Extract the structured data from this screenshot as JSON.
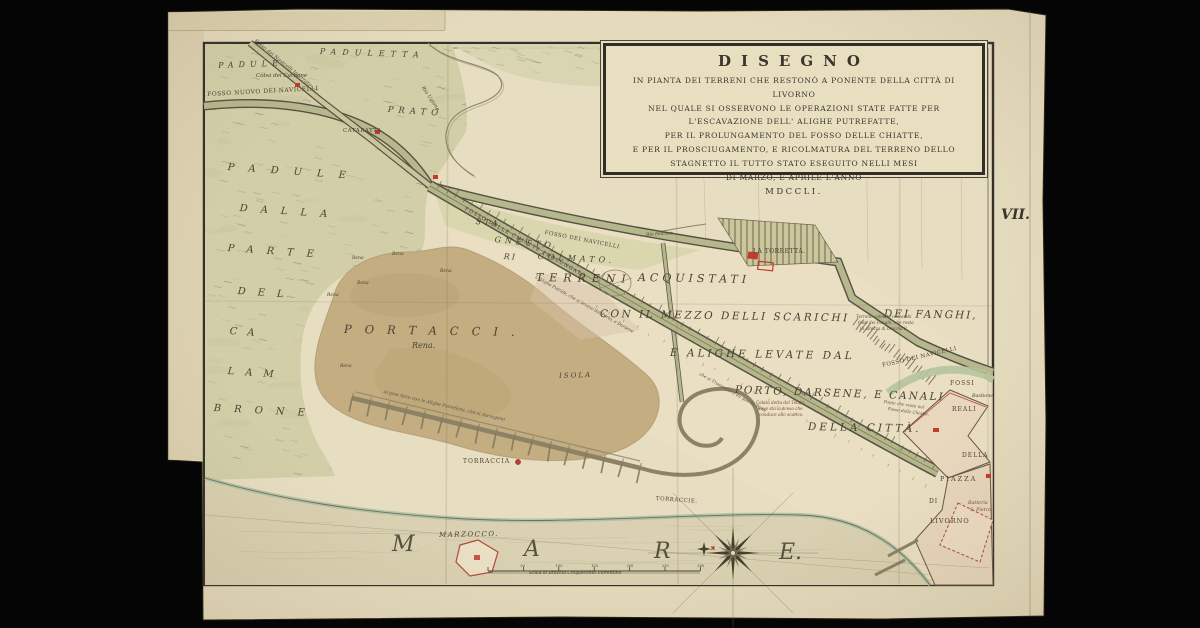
{
  "cartouche": {
    "title": "DISEGNO",
    "lines": [
      "IN PIANTA DEI TERRENI CHE RESTONÒ A PONENTE DELLA CITTÀ DI LIVORNO",
      "NEL QUALE SI OSSERVONO LE OPERAZIONI STATE FATTE PER",
      "L'ESCAVAZIONE DELL' ALIGHE PUTREFATTE,",
      "PER IL PROLUNGAMENTO DEL FOSSO DELLE CHIATTE,",
      "E PER IL PROSCIUGAMENTO, E RICOLMATURA DEL TERRENO DELLO",
      "STAGNETTO IL TUTTO STATO ESEGUITO NELLI MESI",
      "DI MARZO, E APRILE L'ANNO",
      "MDCCLI."
    ]
  },
  "plate_mark": "VII.",
  "scale_bar": {
    "label": "Scala di Braccia Cinquecento Fiorentine",
    "ticks": [
      "50",
      "100",
      "150",
      "200",
      "250",
      "300"
    ]
  },
  "colors": {
    "paper": "#e4dabc",
    "marsh": "#d2cfa8",
    "sand": "#c3ad81",
    "canal": "#b5b68a",
    "accent_red": "#c23b2a",
    "ink": "#4a4334",
    "background": "#050505"
  },
  "map_labels": [
    {
      "n": "padule-top",
      "t": "PADULE",
      "x": 218,
      "y": 62,
      "s": 8,
      "ls": 5,
      "r": -2,
      "i": 1
    },
    {
      "n": "paduletta",
      "t": "PADULETTA",
      "x": 320,
      "y": 48,
      "s": 8,
      "ls": 6,
      "r": 2,
      "i": 1
    },
    {
      "n": "colsa-del-carbone",
      "t": "Cólsa del Carbone",
      "x": 256,
      "y": 74,
      "s": 5.5,
      "i": 1
    },
    {
      "n": "fosso-nuovo-dei-navicelli",
      "t": "FOSSO NUOVO DEI NAVICELLI",
      "x": 207,
      "y": 92,
      "s": 6,
      "ls": 0.5,
      "r": -3
    },
    {
      "n": "fosso-navicelli-interrato",
      "t": "Fosso dei Navicelli Interrato",
      "x": 256,
      "y": 39,
      "s": 5,
      "r": 39,
      "i": 1
    },
    {
      "n": "rio-ugione",
      "t": "Rio Ugione",
      "x": 424,
      "y": 86,
      "s": 5,
      "r": 56,
      "i": 1
    },
    {
      "n": "prato",
      "t": "PRATO",
      "x": 388,
      "y": 106,
      "s": 8.5,
      "ls": 5,
      "r": 4,
      "i": 1
    },
    {
      "n": "cataratta",
      "t": "CATARATTA",
      "x": 343,
      "y": 129,
      "s": 5.5,
      "ls": 0.5
    },
    {
      "n": "stagnetto-sta",
      "t": "STA",
      "x": 476,
      "y": 218,
      "s": 8,
      "ls": 3,
      "r": 6,
      "i": 1
    },
    {
      "n": "stagnetto-gnetto",
      "t": "GNETTO",
      "x": 495,
      "y": 236,
      "s": 8,
      "ls": 4,
      "r": 6,
      "i": 1
    },
    {
      "n": "stagnetto-ri",
      "t": "RI",
      "x": 504,
      "y": 253,
      "s": 8,
      "ls": 2,
      "r": 4,
      "i": 1
    },
    {
      "n": "stagnetto-colmato",
      "t": "COLMATO.",
      "x": 538,
      "y": 253,
      "s": 8,
      "ls": 4,
      "r": 3,
      "i": 1
    },
    {
      "n": "fosso-dei-navicelli-mid",
      "t": "FOSSO DEI NAVICELLI",
      "x": 545,
      "y": 231,
      "s": 5.5,
      "ls": 0.5,
      "r": 11
    },
    {
      "n": "rio-felciaio",
      "t": "Rio Felciaio",
      "x": 646,
      "y": 234,
      "s": 4.5,
      "r": -4,
      "i": 1
    },
    {
      "n": "la-torretta",
      "t": "LA TORRETTA.",
      "x": 753,
      "y": 249,
      "s": 6,
      "ls": 0.5
    },
    {
      "n": "terreni",
      "t": "TERRENI",
      "x": 536,
      "y": 272,
      "s": 11,
      "ls": 6,
      "r": 1,
      "i": 1
    },
    {
      "n": "acquistati",
      "t": "ACQUISTATI",
      "x": 638,
      "y": 272,
      "s": 11,
      "ls": 4,
      "r": 1,
      "i": 1
    },
    {
      "n": "con-il-mezzo-delli-scarichi",
      "t": "CON IL MEZZO DELLI SCARICHI",
      "x": 600,
      "y": 309,
      "s": 10.5,
      "ls": 2.5,
      "r": 1,
      "i": 1
    },
    {
      "n": "dei-fanghi",
      "t": "DEI FANGHI,",
      "x": 884,
      "y": 309,
      "s": 10.5,
      "ls": 2,
      "r": 1,
      "i": 1
    },
    {
      "n": "e-alighe-levate-dal",
      "t": "E ALIGHE LEVATE DAL",
      "x": 670,
      "y": 348,
      "s": 10.5,
      "ls": 3,
      "r": 1,
      "i": 1
    },
    {
      "n": "porto-darsene-e-canali",
      "t": "PORTO, DARSENE, E CANALI",
      "x": 735,
      "y": 385,
      "s": 10.5,
      "ls": 2,
      "r": 2,
      "i": 1
    },
    {
      "n": "della-citta",
      "t": "DELLA CITTÀ.",
      "x": 808,
      "y": 422,
      "s": 10.5,
      "ls": 3,
      "r": 1,
      "i": 1
    },
    {
      "n": "padule-vertical",
      "t": "PADULE",
      "x": 228,
      "y": 163,
      "s": 10,
      "ls": 15,
      "r": 4,
      "i": 1
    },
    {
      "n": "dalla",
      "t": "DALLA",
      "x": 240,
      "y": 204,
      "s": 10,
      "ls": 13,
      "r": 4,
      "i": 1
    },
    {
      "n": "parte",
      "t": "PARTE",
      "x": 228,
      "y": 244,
      "s": 10,
      "ls": 13,
      "r": 4,
      "i": 1
    },
    {
      "n": "del",
      "t": "DEL",
      "x": 238,
      "y": 287,
      "s": 10,
      "ls": 12,
      "r": 4,
      "i": 1
    },
    {
      "n": "ca",
      "t": "CA",
      "x": 230,
      "y": 327,
      "s": 10,
      "ls": 10,
      "r": 4,
      "i": 1
    },
    {
      "n": "lam",
      "t": "LAM",
      "x": 228,
      "y": 367,
      "s": 10,
      "ls": 11,
      "r": 4,
      "i": 1
    },
    {
      "n": "brone",
      "t": "BRONE",
      "x": 214,
      "y": 404,
      "s": 10,
      "ls": 13,
      "r": 3,
      "i": 1
    },
    {
      "n": "portacci",
      "t": "PORTACCI.",
      "x": 344,
      "y": 324,
      "s": 11.5,
      "ls": 13,
      "r": 1,
      "i": 1
    },
    {
      "n": "rena-main",
      "t": "Rena.",
      "x": 412,
      "y": 342,
      "s": 8,
      "i": 1
    },
    {
      "n": "rena-1",
      "t": "Rena",
      "x": 352,
      "y": 257,
      "s": 4.5,
      "i": 1
    },
    {
      "n": "rena-2",
      "t": "Rena",
      "x": 392,
      "y": 253,
      "s": 4.5,
      "i": 1
    },
    {
      "n": "rena-3",
      "t": "Rena",
      "x": 440,
      "y": 270,
      "s": 4.5,
      "i": 1
    },
    {
      "n": "rena-4",
      "t": "Rena",
      "x": 357,
      "y": 282,
      "s": 4.5,
      "i": 1
    },
    {
      "n": "rena-5",
      "t": "Rena",
      "x": 327,
      "y": 294,
      "s": 4.5,
      "i": 1
    },
    {
      "n": "rena-6",
      "t": "Rena",
      "x": 340,
      "y": 365,
      "s": 4.5,
      "i": 1
    },
    {
      "n": "isola",
      "t": "ISOLA",
      "x": 559,
      "y": 373,
      "s": 7,
      "ls": 2,
      "r": -2,
      "i": 1
    },
    {
      "n": "argine-annotation",
      "t": "Argine fatto con le Alighe Putrefatte, che si Asciugano",
      "x": 384,
      "y": 391,
      "s": 4.5,
      "r": 13,
      "i": 1,
      "c": "#5a5142"
    },
    {
      "n": "fosso-delle-chiatte",
      "t": "FOSSO DELLE CHIATTE PROLUNGATO",
      "x": 466,
      "y": 207,
      "s": 5,
      "ls": 1.2,
      "r": 29.5,
      "c": "#3d382d"
    },
    {
      "n": "alighe-annotation",
      "t": "L'Alighe Putride, che si levano dal Porto, e Darsene",
      "x": 536,
      "y": 276,
      "s": 4.3,
      "r": 29.5,
      "i": 1,
      "c": "#5a5142"
    },
    {
      "n": "trasporto-annotation",
      "t": "che si Trasportano da questa Parte",
      "x": 700,
      "y": 373,
      "s": 4.3,
      "r": 29.5,
      "i": 1,
      "c": "#5a5142"
    },
    {
      "n": "calata-annotation-1",
      "t": "Calata detta del Telajo,",
      "x": 756,
      "y": 401,
      "s": 4.2,
      "i": 1,
      "c": "#7a4a38"
    },
    {
      "n": "calata-annotation-2",
      "t": "dove sta la scesa che",
      "x": 758,
      "y": 407,
      "s": 4.2,
      "i": 1,
      "c": "#7a4a38"
    },
    {
      "n": "calata-annotation-3",
      "t": "conduce allo scarico.",
      "x": 759,
      "y": 413,
      "s": 4.2,
      "i": 1,
      "c": "#7a4a38"
    },
    {
      "n": "ponte-annotation-1",
      "t": "Ponte che resta nel",
      "x": 884,
      "y": 400,
      "s": 4.2,
      "r": 8,
      "i": 1,
      "c": "#5a5142"
    },
    {
      "n": "ponte-annotation-2",
      "t": "Fosso delle Chiatte.",
      "x": 888,
      "y": 407,
      "s": 4.2,
      "r": 8,
      "i": 1,
      "c": "#5a5142"
    },
    {
      "n": "fanghi-annotation-1",
      "t": "Terreno colmato con ambi",
      "x": 856,
      "y": 315,
      "s": 4.2,
      "i": 1,
      "c": "#5a5142"
    },
    {
      "n": "fanghi-annotation-2",
      "t": "fossi dei Fanghi, che resta",
      "x": 858,
      "y": 321,
      "s": 4.2,
      "i": 1,
      "c": "#5a5142"
    },
    {
      "n": "fanghi-annotation-3",
      "t": "in altezza di braccia 3.",
      "x": 860,
      "y": 327,
      "s": 4.2,
      "i": 1,
      "c": "#5a5142"
    },
    {
      "n": "fosso-dei-navicelli-right",
      "t": "FOSSO DEI NAVICELLI",
      "x": 882,
      "y": 364,
      "s": 5.5,
      "ls": 0.5,
      "r": -13
    },
    {
      "n": "fossi",
      "t": "FOSSI",
      "x": 950,
      "y": 381,
      "s": 6,
      "ls": 1
    },
    {
      "n": "bastione",
      "t": "Bastione",
      "x": 972,
      "y": 395,
      "s": 4.8,
      "i": 1
    },
    {
      "n": "reali",
      "t": "REALI",
      "x": 952,
      "y": 407,
      "s": 6,
      "ls": 1
    },
    {
      "n": "della-piazza",
      "t": "DELLA",
      "x": 962,
      "y": 453,
      "s": 6,
      "ls": 1
    },
    {
      "n": "piazza",
      "t": "PIAZZA",
      "x": 940,
      "y": 476,
      "s": 6.5,
      "ls": 2
    },
    {
      "n": "di",
      "t": "DI",
      "x": 929,
      "y": 499,
      "s": 6,
      "ls": 1
    },
    {
      "n": "livorno",
      "t": "LIVORNO",
      "x": 930,
      "y": 518,
      "s": 6.5,
      "ls": 1
    },
    {
      "n": "batteria-1",
      "t": "Batteria",
      "x": 968,
      "y": 502,
      "s": 4.8,
      "i": 1,
      "c": "#7a4a38"
    },
    {
      "n": "batteria-2",
      "t": "S. Pietro.",
      "x": 970,
      "y": 509,
      "s": 4.8,
      "i": 1,
      "c": "#7a4a38"
    },
    {
      "n": "torraccia",
      "t": "TORRACCIA",
      "x": 463,
      "y": 459,
      "s": 6,
      "ls": 1
    },
    {
      "n": "torraccie",
      "t": "TORRACCIE.",
      "x": 656,
      "y": 497,
      "s": 5.5,
      "ls": 0.5,
      "r": 4
    },
    {
      "n": "marzocco",
      "t": "MARZOCCO.",
      "x": 439,
      "y": 532,
      "s": 7,
      "ls": 1.5,
      "r": -1,
      "i": 1
    },
    {
      "n": "mare-m",
      "t": "M",
      "x": 392,
      "y": 534,
      "s": 22,
      "i": 1,
      "c": "#56513f"
    },
    {
      "n": "mare-a",
      "t": "A",
      "x": 524,
      "y": 539,
      "s": 22,
      "i": 1,
      "c": "#56513f"
    },
    {
      "n": "mare-r",
      "t": "R",
      "x": 654,
      "y": 541,
      "s": 22,
      "i": 1,
      "c": "#56513f"
    },
    {
      "n": "mare-e",
      "t": "E.",
      "x": 779,
      "y": 542,
      "s": 22,
      "i": 1,
      "c": "#56513f"
    },
    {
      "n": "scala-label",
      "t": "Scala di Braccia Cinquecento Fiorentine",
      "x": 529,
      "y": 572,
      "s": 4.5,
      "i": 1
    },
    {
      "n": "plate-number",
      "t": "VII.",
      "x": 1001,
      "y": 208,
      "s": 14,
      "i": 1,
      "w": 700,
      "c": "#39332a"
    }
  ]
}
